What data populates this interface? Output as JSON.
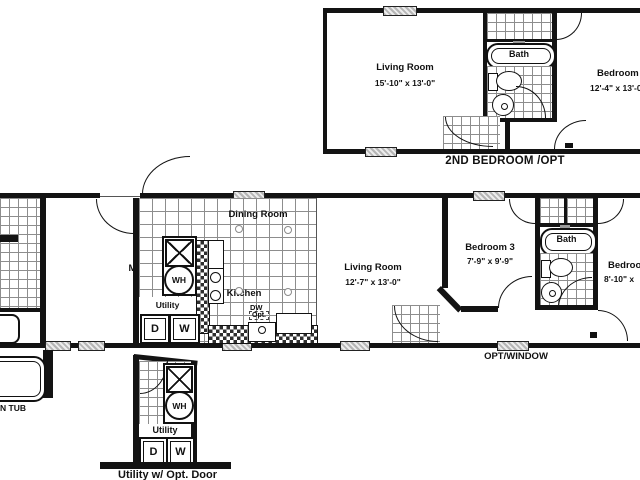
{
  "plans": {
    "second_bedroom_option": {
      "caption": "2ND BEDROOM /OPT",
      "living_room": {
        "name": "Living Room",
        "dims": "15'-10\" x 13'-0\""
      },
      "bath_label": "Bath",
      "bedroom2": {
        "name": "Bedroom 2",
        "dims": "12'-4\" x 13'-0\""
      }
    },
    "main": {
      "master_bedroom": {
        "name": "Master Bedroom",
        "dims": "10'-10\" x 13'-0\""
      },
      "dining_room": {
        "name": "Dining Room"
      },
      "kitchen": {
        "name": "Kitchen"
      },
      "dishwasher": {
        "label": "DW",
        "opt": "Opt."
      },
      "utility": {
        "name": "Utility",
        "dryer": "D",
        "washer": "W",
        "water_heater": "WH"
      },
      "living_room": {
        "name": "Living Room",
        "dims": "12'-7\" x 13'-0\""
      },
      "bedroom3": {
        "name": "Bedroom 3",
        "dims": "7'-9\" x 9'-9\""
      },
      "bath_label": "Bath",
      "bedroom_right": {
        "name": "Bedroom",
        "dims": "8'-10\" x"
      },
      "window_caption": "OPT/WINDOW"
    },
    "garden_tub_detail": {
      "label": "N TUB"
    },
    "utility_detail": {
      "caption": "Utility w/ Opt. Door",
      "name": "Utility",
      "dryer": "D",
      "washer": "W",
      "water_heater": "WH"
    }
  },
  "colors": {
    "line": "#131313",
    "tile_line": "#8d8d8d",
    "hatch_fill": "#b5b5b5",
    "background": "#ffffff"
  }
}
